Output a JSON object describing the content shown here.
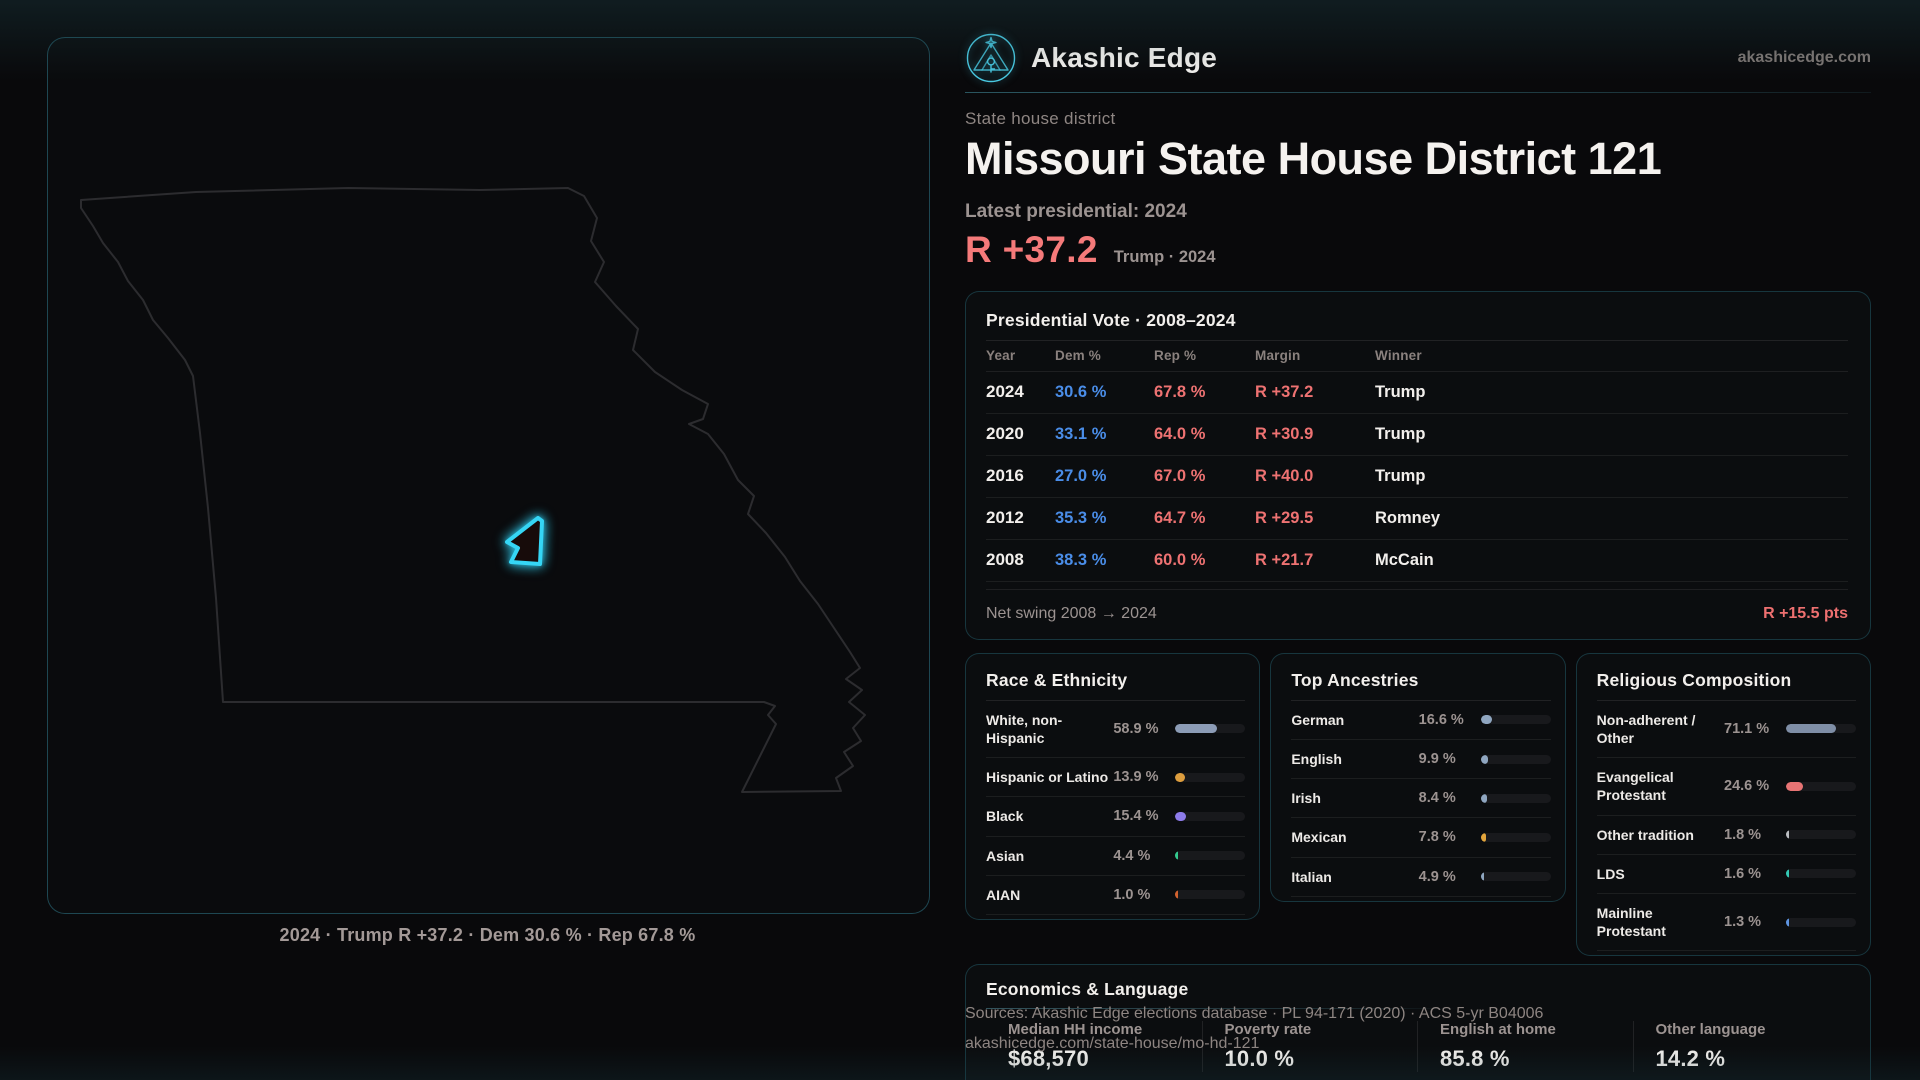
{
  "brand": {
    "name": "Akashic Edge",
    "domain": "akashicedge.com"
  },
  "header": {
    "kicker": "State house district",
    "title": "Missouri State House District 121",
    "latest_label": "Latest presidential: 2024",
    "headline_margin": "R +37.2",
    "headline_caption": "Trump · 2024"
  },
  "map": {
    "caption": "2024 · Trump R +37.2 · Dem 30.6 % · Rep 67.8 %"
  },
  "presidential": {
    "title": "Presidential Vote · 2008–2024",
    "columns": [
      "Year",
      "Dem %",
      "Rep %",
      "Margin",
      "Winner"
    ],
    "rows": [
      {
        "year": "2024",
        "dem": "30.6 %",
        "rep": "67.8 %",
        "margin": "R +37.2",
        "winner": "Trump"
      },
      {
        "year": "2020",
        "dem": "33.1 %",
        "rep": "64.0 %",
        "margin": "R +30.9",
        "winner": "Trump"
      },
      {
        "year": "2016",
        "dem": "27.0 %",
        "rep": "67.0 %",
        "margin": "R +40.0",
        "winner": "Trump"
      },
      {
        "year": "2012",
        "dem": "35.3 %",
        "rep": "64.7 %",
        "margin": "R +29.5",
        "winner": "Romney"
      },
      {
        "year": "2008",
        "dem": "38.3 %",
        "rep": "60.0 %",
        "margin": "R +21.7",
        "winner": "McCain"
      }
    ],
    "footer_label": "Net swing 2008 → 2024",
    "footer_value": "R +15.5 pts"
  },
  "race": {
    "title": "Race & Ethnicity",
    "rows": [
      {
        "label": "White, non-Hispanic",
        "value": "58.9 %",
        "pct": 58.9,
        "color": "#8c9cb6"
      },
      {
        "label": "Hispanic or Latino",
        "value": "13.9 %",
        "pct": 13.9,
        "color": "#dd9d3e"
      },
      {
        "label": "Black",
        "value": "15.4 %",
        "pct": 15.4,
        "color": "#8d7bea"
      },
      {
        "label": "Asian",
        "value": "4.4 %",
        "pct": 4.4,
        "color": "#33c98e"
      },
      {
        "label": "AIAN",
        "value": "1.0 %",
        "pct": 1.0,
        "color": "#d2622f"
      }
    ]
  },
  "ancestries": {
    "title": "Top Ancestries",
    "rows": [
      {
        "label": "German",
        "value": "16.6 %",
        "pct": 16.6,
        "color": "#8fa6c0"
      },
      {
        "label": "English",
        "value": "9.9 %",
        "pct": 9.9,
        "color": "#8fa6c0"
      },
      {
        "label": "Irish",
        "value": "8.4 %",
        "pct": 8.4,
        "color": "#8fa6c0"
      },
      {
        "label": "Mexican",
        "value": "7.8 %",
        "pct": 7.8,
        "color": "#e2a53c"
      },
      {
        "label": "Italian",
        "value": "4.9 %",
        "pct": 4.9,
        "color": "#8fa6c0"
      }
    ]
  },
  "religion": {
    "title": "Religious Composition",
    "rows": [
      {
        "label": "Non-adherent / Other",
        "value": "71.1 %",
        "pct": 71.1,
        "color": "#7f8ea6"
      },
      {
        "label": "Evangelical Protestant",
        "value": "24.6 %",
        "pct": 24.6,
        "color": "#e87474"
      },
      {
        "label": "Other tradition",
        "value": "1.8 %",
        "pct": 1.8,
        "color": "#b9bcc0"
      },
      {
        "label": "LDS",
        "value": "1.6 %",
        "pct": 1.6,
        "color": "#33c9b4"
      },
      {
        "label": "Mainline Protestant",
        "value": "1.3 %",
        "pct": 1.3,
        "color": "#5e94e0"
      }
    ]
  },
  "economics": {
    "title": "Economics & Language",
    "stats": [
      {
        "label": "Median HH income",
        "value": "$68,570"
      },
      {
        "label": "Poverty rate",
        "value": "10.0 %"
      },
      {
        "label": "English at home",
        "value": "85.8 %"
      },
      {
        "label": "Other language",
        "value": "14.2 %"
      }
    ]
  },
  "sources": {
    "line1": "Sources: Akashic Edge elections database · PL 94-171 (2020) · ACS 5-yr B04006",
    "line2": "akashicedge.com/state-house/mo-hd-121"
  },
  "colors": {
    "accent_cyan": "#35d6f5",
    "dem_blue": "#4a8de8",
    "rep_red": "#ee7272"
  }
}
